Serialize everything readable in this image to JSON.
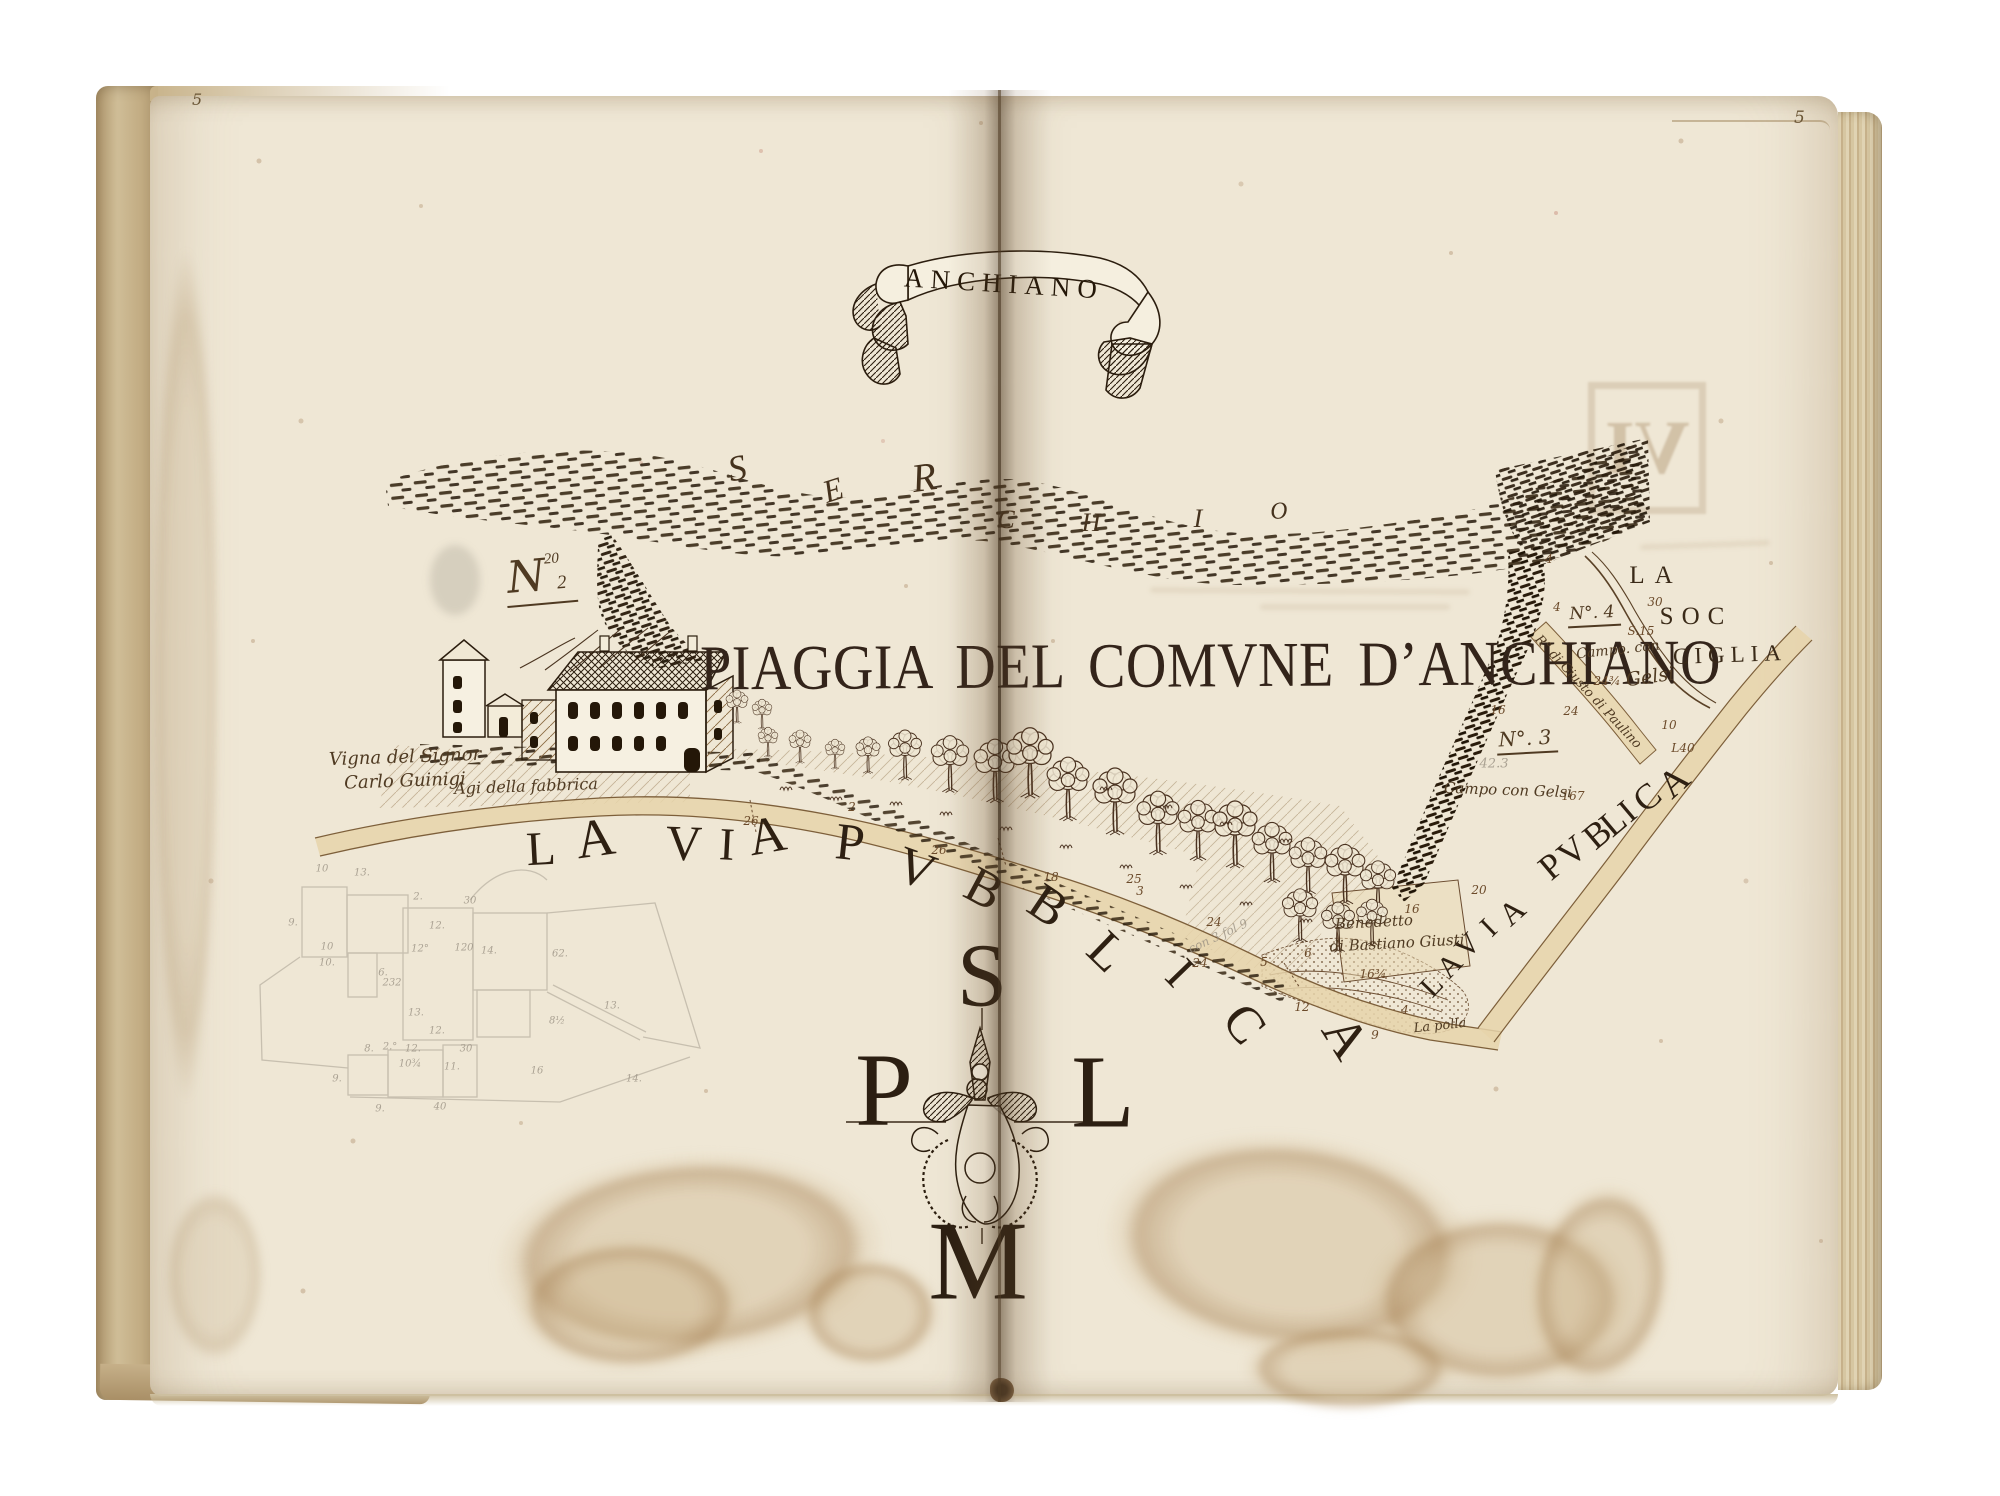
{
  "book": {
    "folio_left": "5",
    "folio_right": "5"
  },
  "banner": {
    "title": "ANCHIANO"
  },
  "map": {
    "main_title": "PIAGGIA DEL COMVNE D’ANCHIANO",
    "river_name": "SERCHIO",
    "stamp_glyph": "VI",
    "labels": {
      "la": "LA",
      "soc": "SOC",
      "ciglia": "CIGLIA",
      "n4": "N°. 4",
      "campo4": "Campo. con",
      "gelsi4": "Gelsi",
      "rgiusto": "R° di Giusto di Paulino",
      "n3": "N°. 3",
      "campo3": "Campo con Gelsi",
      "benedetto1": "Benedetto",
      "benedetto2": "di Bastiano Giusti",
      "lapolla": "La polla",
      "vigna1": "Vigna del Signor",
      "vigna2": "Carlo Guinigi",
      "agi": "Agi della fabbrica",
      "n2_n": "N",
      "n2_sup": "20",
      "n2_sub": "2"
    },
    "compass": {
      "s": "S",
      "p": "P",
      "l": "L",
      "m": "M"
    }
  },
  "scatter": {
    "river_letters": [
      {
        "t": "S",
        "x": 737,
        "y": 468,
        "s": 36,
        "r": -12
      },
      {
        "t": "E",
        "x": 833,
        "y": 490,
        "s": 32,
        "r": -18
      },
      {
        "t": "R",
        "x": 924,
        "y": 477,
        "s": 40,
        "r": -8
      },
      {
        "t": "C",
        "x": 1006,
        "y": 520,
        "s": 26,
        "r": 0
      },
      {
        "t": "H",
        "x": 1091,
        "y": 523,
        "s": 26,
        "r": 0
      },
      {
        "t": "I",
        "x": 1198,
        "y": 519,
        "s": 26,
        "r": 0
      },
      {
        "t": "O",
        "x": 1279,
        "y": 512,
        "s": 24,
        "r": -6
      }
    ],
    "via_letters": [
      {
        "t": "L",
        "x": 541,
        "y": 849,
        "s": 48,
        "r": -3
      },
      {
        "t": "A",
        "x": 595,
        "y": 838,
        "s": 54,
        "r": -8
      },
      {
        "t": "V",
        "x": 684,
        "y": 843,
        "s": 50,
        "r": 2
      },
      {
        "t": "I",
        "x": 727,
        "y": 844,
        "s": 46,
        "r": 3
      },
      {
        "t": "A",
        "x": 767,
        "y": 836,
        "s": 52,
        "r": -10
      },
      {
        "t": "P",
        "x": 850,
        "y": 843,
        "s": 52,
        "r": 6
      },
      {
        "t": "V",
        "x": 916,
        "y": 869,
        "s": 52,
        "r": 20
      },
      {
        "t": "B",
        "x": 984,
        "y": 889,
        "s": 52,
        "r": 28
      },
      {
        "t": "B",
        "x": 1048,
        "y": 906,
        "s": 52,
        "r": 34
      },
      {
        "t": "L",
        "x": 1107,
        "y": 952,
        "s": 52,
        "r": 44
      },
      {
        "t": "I",
        "x": 1180,
        "y": 973,
        "s": 48,
        "r": 46
      },
      {
        "t": "C",
        "x": 1244,
        "y": 1024,
        "s": 52,
        "r": 52
      },
      {
        "t": "A",
        "x": 1346,
        "y": 1037,
        "s": 54,
        "r": 58
      }
    ],
    "diag_letters": [
      {
        "t": "L",
        "x": 1432,
        "y": 986,
        "s": 30,
        "r": -46
      },
      {
        "t": "A",
        "x": 1450,
        "y": 966,
        "s": 30,
        "r": -46
      },
      {
        "t": "V",
        "x": 1468,
        "y": 946,
        "s": 30,
        "r": -46
      },
      {
        "t": "I",
        "x": 1489,
        "y": 928,
        "s": 30,
        "r": -44
      },
      {
        "t": "A",
        "x": 1512,
        "y": 912,
        "s": 32,
        "r": -42
      },
      {
        "t": "P",
        "x": 1551,
        "y": 866,
        "s": 36,
        "r": -40
      },
      {
        "t": "V",
        "x": 1572,
        "y": 851,
        "s": 36,
        "r": -40
      },
      {
        "t": "B",
        "x": 1597,
        "y": 834,
        "s": 36,
        "r": -40
      },
      {
        "t": "L",
        "x": 1613,
        "y": 822,
        "s": 36,
        "r": -40
      },
      {
        "t": "I",
        "x": 1628,
        "y": 812,
        "s": 34,
        "r": -40
      },
      {
        "t": "C",
        "x": 1647,
        "y": 797,
        "s": 36,
        "r": -40
      },
      {
        "t": "A",
        "x": 1674,
        "y": 782,
        "s": 38,
        "r": -42
      }
    ],
    "measurements": [
      {
        "t": "26",
        "x": 751,
        "y": 821
      },
      {
        "t": "2",
        "x": 852,
        "y": 807
      },
      {
        "t": "26",
        "x": 939,
        "y": 850
      },
      {
        "t": "18",
        "x": 1051,
        "y": 877
      },
      {
        "t": "25",
        "x": 1134,
        "y": 879
      },
      {
        "t": "3",
        "x": 1140,
        "y": 891
      },
      {
        "t": "24",
        "x": 1214,
        "y": 922
      },
      {
        "t": "24",
        "x": 1200,
        "y": 963
      },
      {
        "t": "5",
        "x": 1264,
        "y": 962
      },
      {
        "t": "6",
        "x": 1308,
        "y": 953
      },
      {
        "t": "12",
        "x": 1302,
        "y": 1007
      },
      {
        "t": "9",
        "x": 1375,
        "y": 1035
      },
      {
        "t": "16",
        "x": 1412,
        "y": 909
      },
      {
        "t": "16¾",
        "x": 1373,
        "y": 974
      },
      {
        "t": "4",
        "x": 1405,
        "y": 1010
      },
      {
        "t": "4",
        "x": 1549,
        "y": 559
      },
      {
        "t": "4",
        "x": 1557,
        "y": 607
      },
      {
        "t": "30",
        "x": 1655,
        "y": 602
      },
      {
        "t": "S.15",
        "x": 1641,
        "y": 631
      },
      {
        "t": "24¾",
        "x": 1607,
        "y": 681
      },
      {
        "t": "16",
        "x": 1498,
        "y": 710
      },
      {
        "t": "24",
        "x": 1571,
        "y": 711
      },
      {
        "t": "10",
        "x": 1669,
        "y": 725
      },
      {
        "t": "L40",
        "x": 1683,
        "y": 748
      },
      {
        "t": "167",
        "x": 1573,
        "y": 796
      },
      {
        "t": "20",
        "x": 1479,
        "y": 890
      }
    ],
    "pencil_numbers": [
      {
        "t": "10",
        "x": 322,
        "y": 869
      },
      {
        "t": "13.",
        "x": 362,
        "y": 873
      },
      {
        "t": "9.",
        "x": 293,
        "y": 923
      },
      {
        "t": "2.",
        "x": 418,
        "y": 897
      },
      {
        "t": "30",
        "x": 470,
        "y": 901
      },
      {
        "t": "12.",
        "x": 437,
        "y": 926
      },
      {
        "t": "12°",
        "x": 420,
        "y": 949
      },
      {
        "t": "120",
        "x": 464,
        "y": 948
      },
      {
        "t": "14.",
        "x": 489,
        "y": 951
      },
      {
        "t": "10",
        "x": 327,
        "y": 947
      },
      {
        "t": "10.",
        "x": 327,
        "y": 963
      },
      {
        "t": "6.",
        "x": 383,
        "y": 973
      },
      {
        "t": "232",
        "x": 392,
        "y": 983
      },
      {
        "t": "13.",
        "x": 416,
        "y": 1013
      },
      {
        "t": "12.",
        "x": 437,
        "y": 1031
      },
      {
        "t": "8.",
        "x": 369,
        "y": 1049
      },
      {
        "t": "2.°",
        "x": 390,
        "y": 1047
      },
      {
        "t": "12.",
        "x": 413,
        "y": 1049
      },
      {
        "t": "30",
        "x": 466,
        "y": 1049
      },
      {
        "t": "11.",
        "x": 452,
        "y": 1067
      },
      {
        "t": "10¾",
        "x": 410,
        "y": 1064
      },
      {
        "t": "9.",
        "x": 337,
        "y": 1079
      },
      {
        "t": "9.",
        "x": 380,
        "y": 1109
      },
      {
        "t": "40",
        "x": 440,
        "y": 1107
      },
      {
        "t": "16",
        "x": 537,
        "y": 1071
      },
      {
        "t": "14.",
        "x": 634,
        "y": 1079
      },
      {
        "t": "13.",
        "x": 612,
        "y": 1006
      },
      {
        "t": "8½",
        "x": 557,
        "y": 1021
      },
      {
        "t": "62.",
        "x": 560,
        "y": 954
      }
    ],
    "pencil_words": [
      {
        "t": "42.3",
        "x": 1494,
        "y": 764,
        "s": 13,
        "r": 0
      },
      {
        "t": "con 3 fol 9",
        "x": 1218,
        "y": 936,
        "s": 12,
        "r": -25
      }
    ]
  }
}
